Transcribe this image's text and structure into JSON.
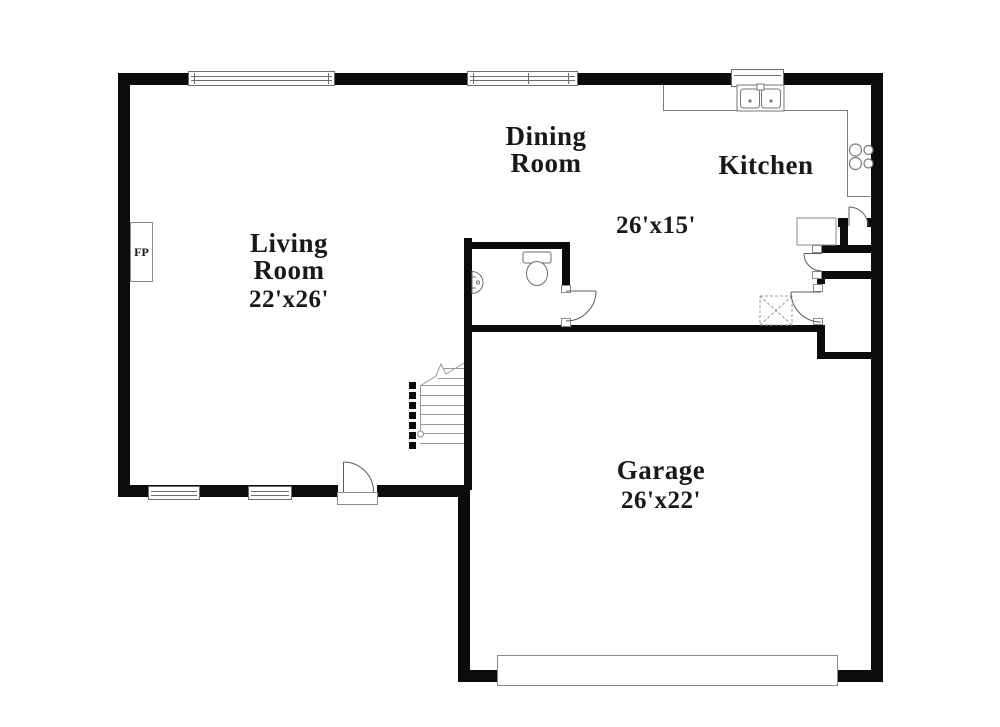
{
  "rooms": {
    "living": {
      "name": "Living Room",
      "dims": "22'x26'"
    },
    "dining": {
      "name": "Dining Room",
      "dims": "26'x15'"
    },
    "kitchen": {
      "name": "Kitchen"
    },
    "garage": {
      "name": "Garage",
      "dims": "26'x22'"
    }
  },
  "fireplace": {
    "label": "FP"
  },
  "fixtures": [
    "fireplace",
    "double-kitchen-sink",
    "stove-cooktop",
    "refrigerator",
    "toilet",
    "pedestal-sink",
    "staircase",
    "hvac-unit-x",
    "garage-door",
    "window",
    "door-swing"
  ],
  "colors": {
    "wall": "#0b0b0b",
    "floor": "#ffffff",
    "fixture_line": "#6e6e6e",
    "text": "#191919"
  }
}
